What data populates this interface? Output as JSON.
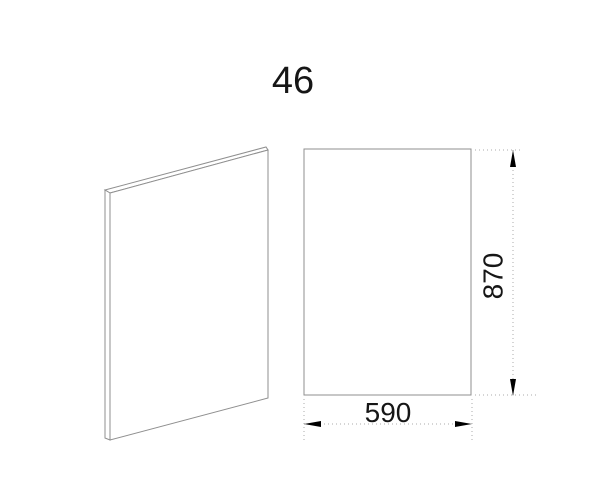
{
  "drawing": {
    "title": "46",
    "dimensions": {
      "width": {
        "value": "590"
      },
      "height": {
        "value": "870"
      }
    },
    "colors": {
      "background": "#ffffff",
      "outline": "#8f8f8f",
      "dimension_dots": "#ababab",
      "arrow": "#000000",
      "text": "#161616"
    }
  }
}
